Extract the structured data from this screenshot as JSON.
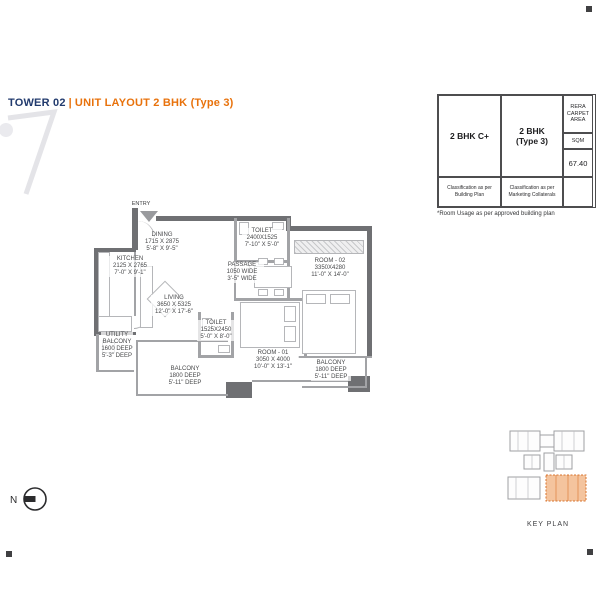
{
  "page": {
    "title_prefix": "TOWER 02",
    "title_separator": "|",
    "title_main": "UNIT LAYOUT 2 BHK (Type 3)",
    "footnote": "*Room Usage as per approved building plan",
    "key_plan_label": "KEY PLAN",
    "north_label": "N"
  },
  "colors": {
    "accent_orange": "#e8720c",
    "title_navy": "#213a6d",
    "wall_gray": "#6f7073",
    "keyplan_highlight": "#f4c49e",
    "keyplan_highlight_border": "#d8742f"
  },
  "area_table": {
    "columns": [
      {
        "label": "2 BHK C+",
        "footer": "Classification as per Building Plan"
      },
      {
        "label": "2 BHK (Type 3)",
        "footer": "Classification as per Marketing Collaterals"
      }
    ],
    "area_header": "RERA CARPET AREA",
    "area_unit": "SQM",
    "area_value": "67.40"
  },
  "floor_plan": {
    "entry_label": "ENTRY",
    "rooms": {
      "kitchen": {
        "name": "KITCHEN",
        "dim_mm": "2125 X 2765",
        "dim_ft": "7'-0\" X 9'-1\""
      },
      "dining": {
        "name": "DINING",
        "dim_mm": "1715 X 2875",
        "dim_ft": "5'-8\" X 9'-5\""
      },
      "toilet_top": {
        "name": "TOILET",
        "dim_mm": "2400X1525",
        "dim_ft": "7'-10\" X 5'-0\""
      },
      "passage": {
        "name": "PASSAGE",
        "dim_mm": "1050 WIDE",
        "dim_ft": "3'-5\" WIDE"
      },
      "living": {
        "name": "LIVING",
        "dim_mm": "3650 X 5325",
        "dim_ft": "12'-0\" X 17'-6\""
      },
      "toilet_mid": {
        "name": "TOILET",
        "dim_mm": "1525X2450",
        "dim_ft": "5'-0\" X 8'-0\""
      },
      "room02": {
        "name": "ROOM - 02",
        "dim_mm": "3350X4280",
        "dim_ft": "11'-0\" X 14'-0\""
      },
      "room01": {
        "name": "ROOM - 01",
        "dim_mm": "3050 X 4000",
        "dim_ft": "10'-0\" X 13'-1\""
      },
      "utility": {
        "name": "UTILITY BALCONY",
        "dim_mm": "1600 DEEP",
        "dim_ft": "5'-3\" DEEP"
      },
      "balcony_left": {
        "name": "BALCONY",
        "dim_mm": "1800 DEEP",
        "dim_ft": "5'-11\" DEEP"
      },
      "balcony_right": {
        "name": "BALCONY",
        "dim_mm": "1800 DEEP",
        "dim_ft": "5'-11\" DEEP"
      }
    }
  }
}
